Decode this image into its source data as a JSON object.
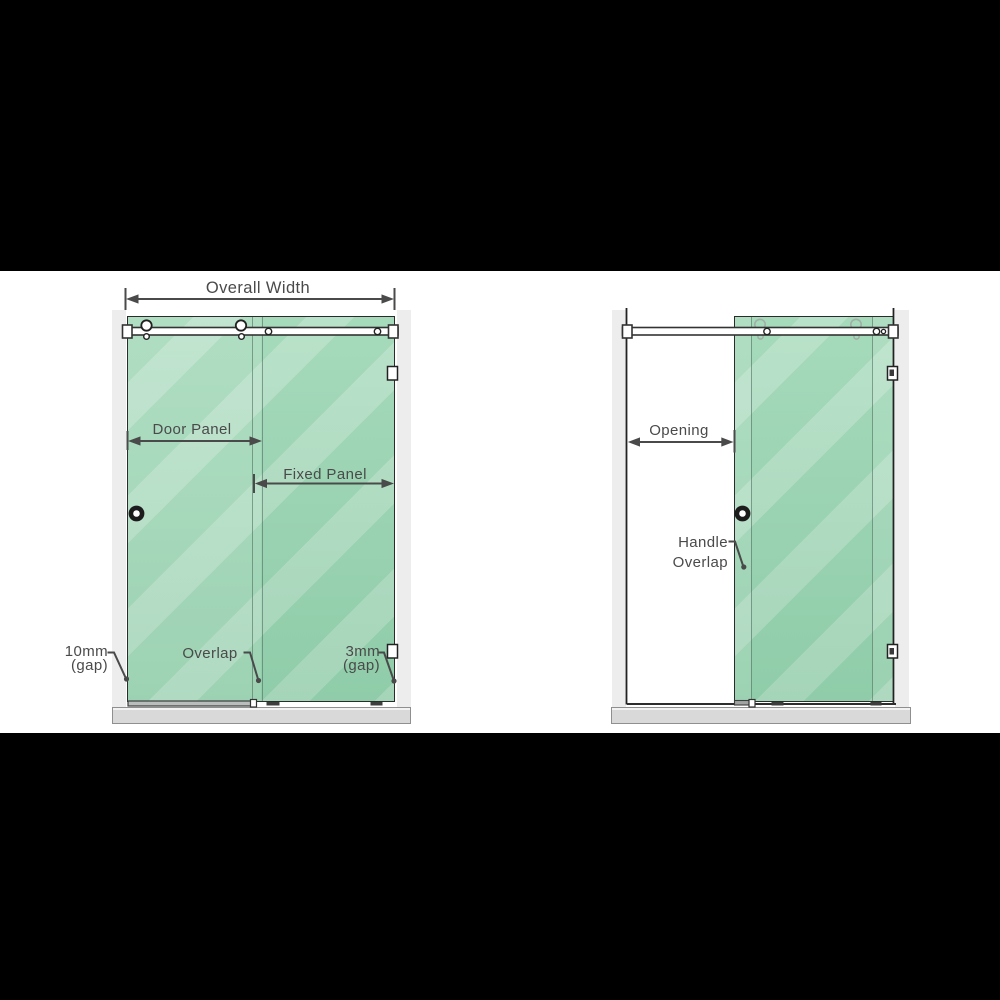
{
  "page": {
    "type": "shower-screen-installation-diagram",
    "views": [
      "closed position",
      "open position"
    ]
  },
  "left": {
    "overall_width": "Overall Width",
    "door_panel": "Door Panel",
    "fixed_panel": "Fixed Panel",
    "gap_left": "10mm",
    "gap_left_sub": "(gap)",
    "overlap": "Overlap",
    "gap_right": "3mm",
    "gap_right_sub": "(gap)"
  },
  "right": {
    "opening": "Opening",
    "handle_line1": "Handle",
    "handle_line2": "Overlap"
  },
  "colors": {
    "letterbox": "#000000",
    "canvas": "#ffffff",
    "glass_green": "#97d4b0",
    "annotation_text": "#4a4a4a",
    "hardware_line": "#222222",
    "wall_strip": "#ededed",
    "floor_base": "#d9d9d9"
  }
}
